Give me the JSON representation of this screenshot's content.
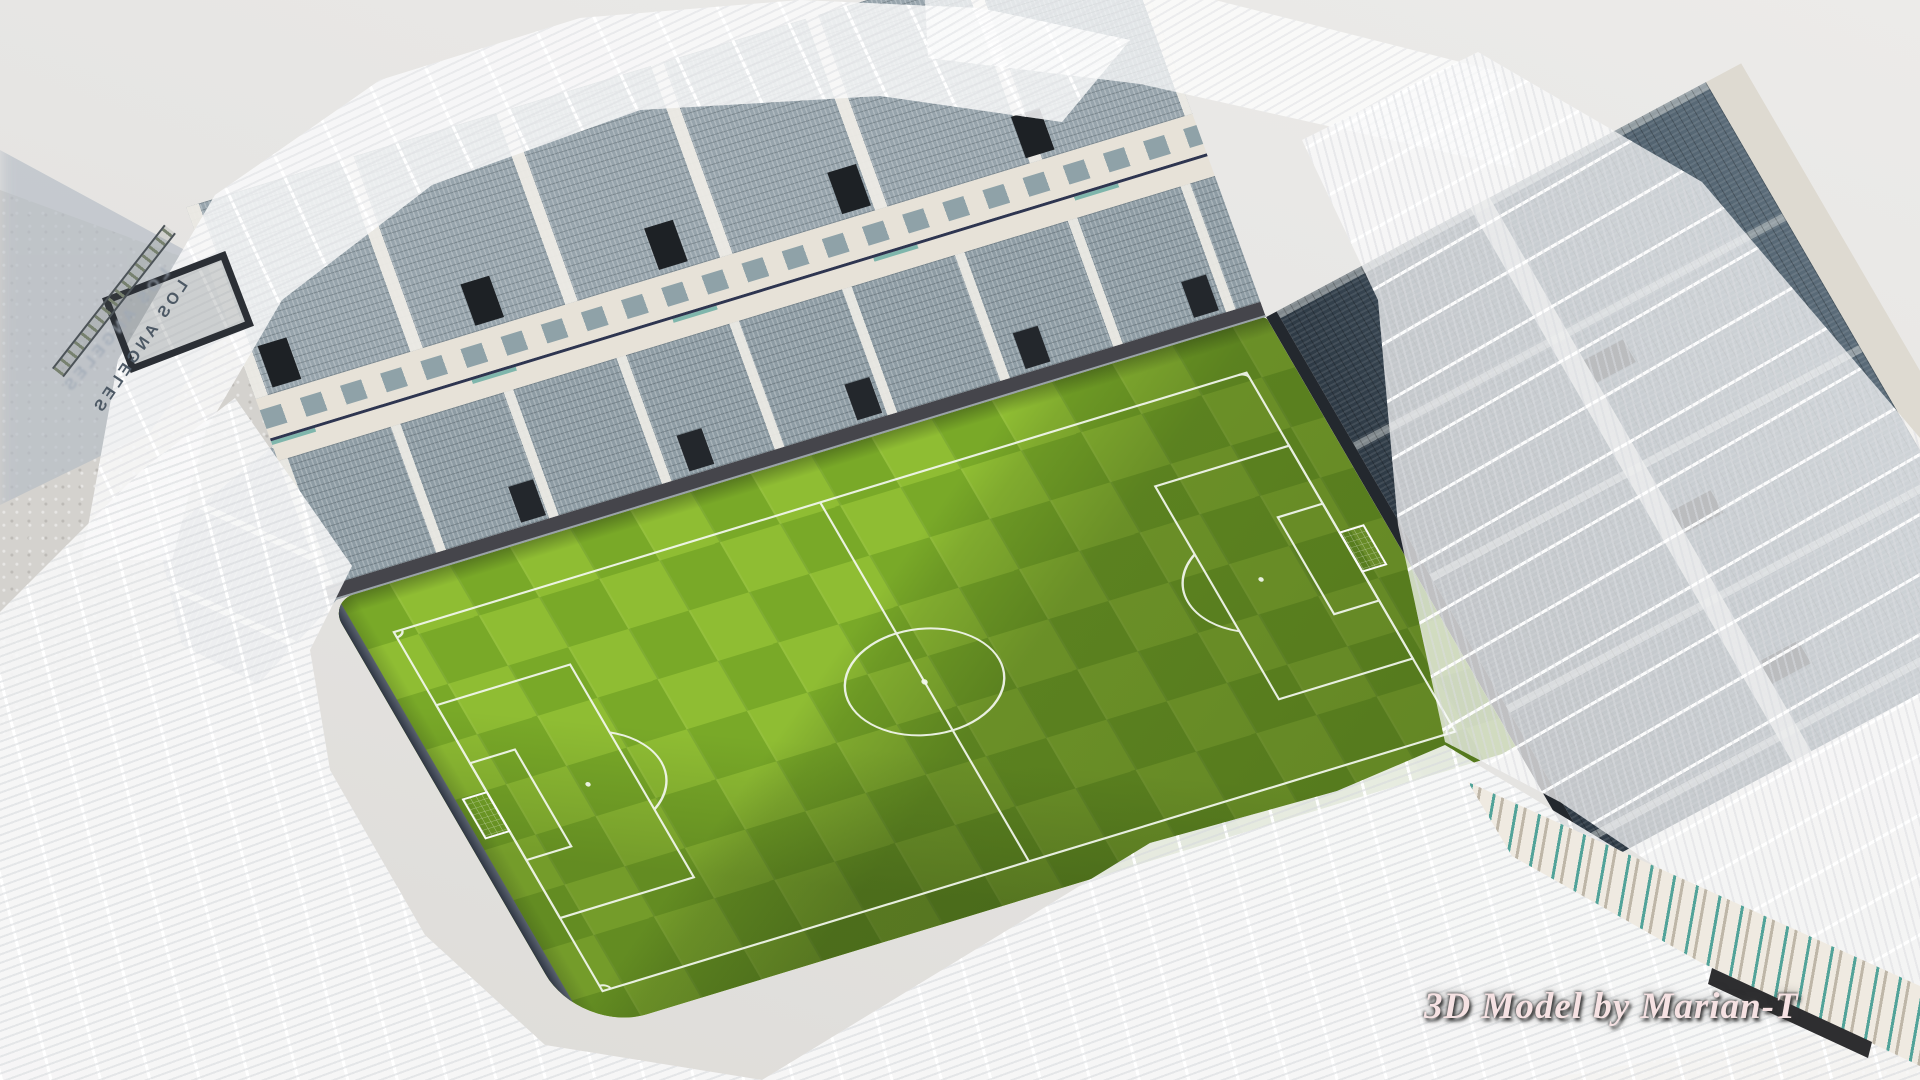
{
  "scene": {
    "description": "Aerial 3D render of an empty soccer stadium with a translucent white lattice roof, gray seating bowl and a green checker-mown pitch"
  },
  "watermark": {
    "text": "3D Model by Marian-T"
  },
  "signage": {
    "stadium_sign_text": "LOS ANGELES"
  },
  "palette": {
    "background": "#e8e7e5",
    "concrete": "#d4d2ce",
    "ground_tan": "#d8cdbb",
    "grass_light": "#8fbd33",
    "grass_dark": "#79a928",
    "pitch_line": "#f4f8f0",
    "north_seats": "#91a0a8",
    "east_seats_dark": "#2e3a45",
    "east_seats_light": "#5a6b78",
    "roof_white": "#ffffff",
    "structure_cream": "#e7e2d8",
    "wall_dark": "#45454b",
    "accent_teal": "#2a9187",
    "accent_navy": "#2e3550",
    "shadow_blue": "#b6bdc6",
    "watermark_fill": "#f6e2e3",
    "sign_text": "#4d5965"
  }
}
